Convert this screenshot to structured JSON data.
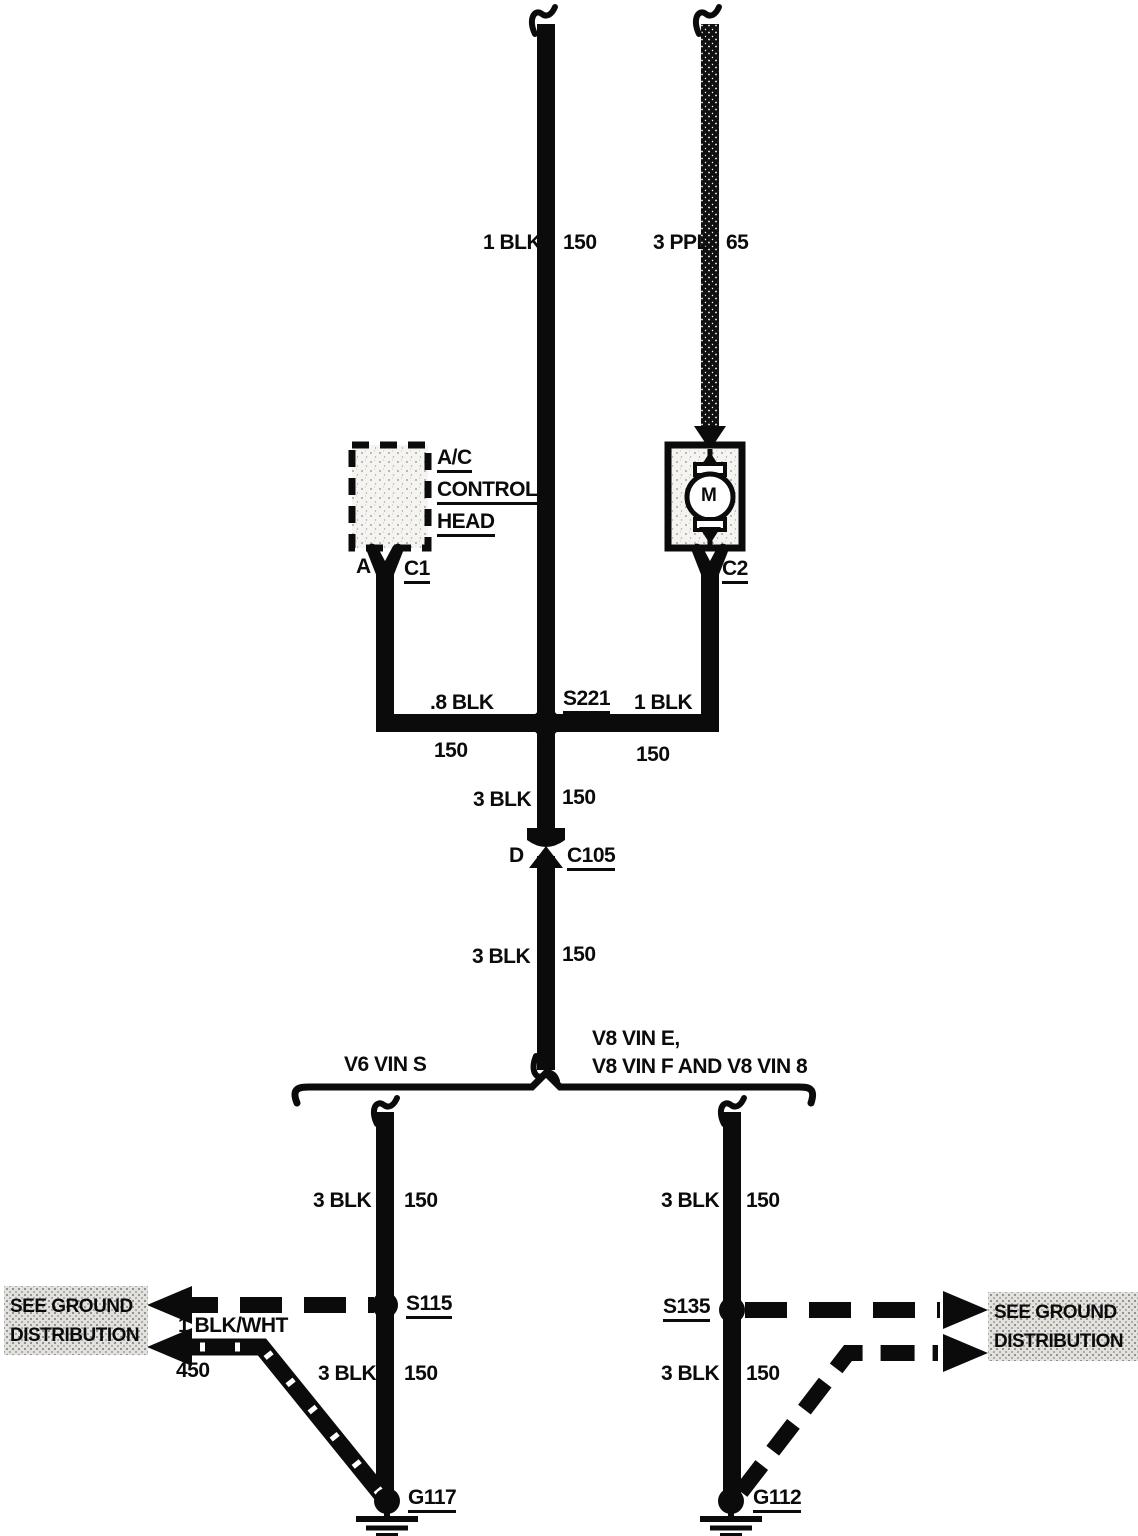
{
  "palette": {
    "ink": "#0b0b0b",
    "paper": "#ffffff"
  },
  "wires": {
    "top_left": {
      "label": "1 BLK",
      "circuit": "150"
    },
    "top_right": {
      "label": "3 PPL",
      "circuit": "65"
    },
    "splice_left": {
      "label": ".8 BLK",
      "circuit": "150"
    },
    "splice_right": {
      "label": "1 BLK",
      "circuit": "150"
    },
    "trunk_upper": {
      "label": "3 BLK",
      "circuit": "150"
    },
    "trunk_lower": {
      "label": "3 BLK",
      "circuit": "150"
    },
    "v6_upper": {
      "label": "3 BLK",
      "circuit": "150"
    },
    "v6_lower": {
      "label": "3 BLK",
      "circuit": "150"
    },
    "v8_upper": {
      "label": "3 BLK",
      "circuit": "150"
    },
    "v8_lower": {
      "label": "3 BLK",
      "circuit": "150"
    },
    "ground_feed": {
      "label": "1 BLK/WHT",
      "circuit": "450"
    }
  },
  "components": {
    "ac_control_head": {
      "name_line1": "A/C",
      "name_line2": "CONTROL",
      "name_line3": "HEAD",
      "pin": "A",
      "connector": "C1"
    },
    "blower_motor": {
      "symbol": "M",
      "connector": "C2"
    },
    "splice_s221": {
      "id": "S221"
    },
    "connector_c105": {
      "pin": "D",
      "id": "C105"
    },
    "splice_s115": {
      "id": "S115"
    },
    "splice_s135": {
      "id": "S135"
    },
    "ground_g117": {
      "id": "G117"
    },
    "ground_g112": {
      "id": "G112"
    }
  },
  "branches": {
    "left_title": "V6 VIN S",
    "right_title_line1": "V8 VIN E,",
    "right_title_line2": "V8 VIN F AND V8 VIN 8"
  },
  "notes": {
    "see_ground_left": {
      "line1": "SEE GROUND",
      "line2": "DISTRIBUTION"
    },
    "see_ground_right": {
      "line1": "SEE GROUND",
      "line2": "DISTRIBUTION"
    }
  }
}
